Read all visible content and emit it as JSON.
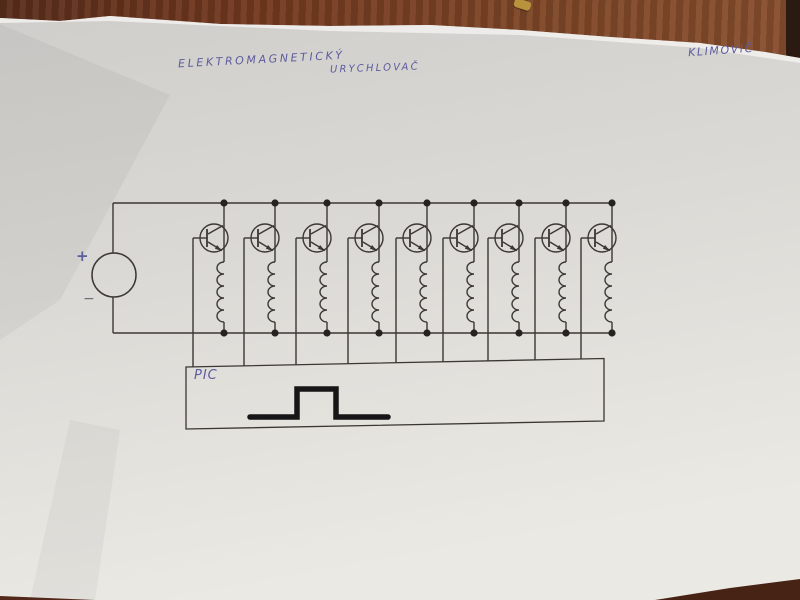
{
  "photo": {
    "description": "hand-drawn circuit schematic on white paper lying on a brown table",
    "table_color": "#74391f",
    "paper_color": "#dbd9d5",
    "ink_color": "#3a3734",
    "pen_ink_color": "#5c5c9e",
    "pulse_color": "#161616"
  },
  "annotations": {
    "title_line1": "ELEKTROMAGNETICKÝ",
    "title_line2": "URYCHLOVAČ",
    "author": "KLIMOVIČ",
    "plus_label": "+",
    "minus_label": "−",
    "controller_label": "PIC"
  },
  "diagram": {
    "type": "circuit-schematic",
    "power_source": "DC supply (circle) with + top terminal and − bottom terminal",
    "stage_count": 9,
    "stage_components": [
      "NPN transistor switch",
      "accelerator coil (inductor)"
    ],
    "rails": [
      "top supply rail",
      "bottom return rail"
    ],
    "controller": "PIC microcontroller driving all transistor bases",
    "waveform": "single square pulse drawn inside PIC box"
  }
}
